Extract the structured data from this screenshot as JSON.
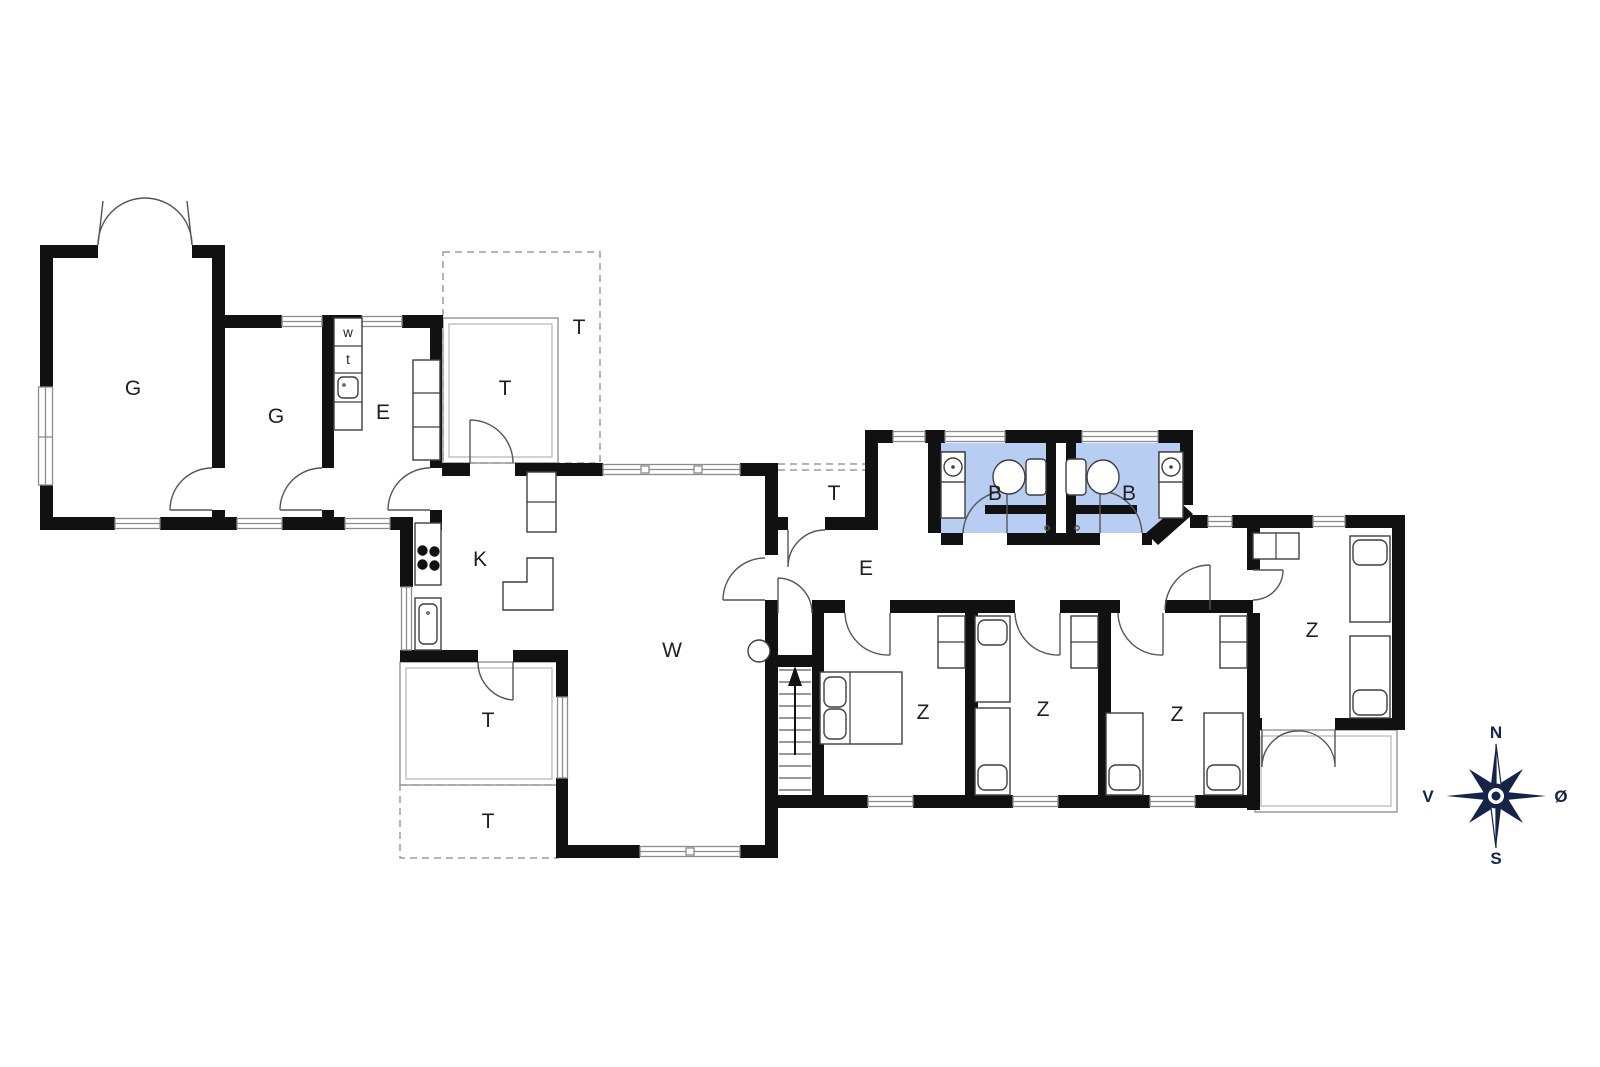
{
  "plan": {
    "type": "floorplan",
    "rooms": [
      {
        "id": "g-large",
        "label": "G"
      },
      {
        "id": "g-small",
        "label": "G"
      },
      {
        "id": "e-utility",
        "label": "E"
      },
      {
        "id": "t-porch",
        "label": "T"
      },
      {
        "id": "t-open",
        "label": "T"
      },
      {
        "id": "k-kitchen",
        "label": "K"
      },
      {
        "id": "w-living",
        "label": "W"
      },
      {
        "id": "t-small",
        "label": "T"
      },
      {
        "id": "e-hall",
        "label": "E"
      },
      {
        "id": "b-left",
        "label": "B"
      },
      {
        "id": "b-right",
        "label": "B"
      },
      {
        "id": "z-east",
        "label": "Z"
      },
      {
        "id": "z-1",
        "label": "Z"
      },
      {
        "id": "z-2",
        "label": "Z"
      },
      {
        "id": "z-3",
        "label": "Z"
      },
      {
        "id": "t-sw-upper",
        "label": "T"
      },
      {
        "id": "t-sw-lower",
        "label": "T"
      }
    ],
    "fixtures": {
      "washer": "w",
      "dryer": "t"
    },
    "compass": {
      "north": "N",
      "south": "S",
      "west": "V",
      "east": "Ø"
    }
  },
  "colors": {
    "wall": "#111111",
    "bathroom_fill": "#b7cdf1",
    "window_line": "#8c8c8c",
    "terrace_line": "#9b9b9b",
    "door_line": "#555555",
    "furniture_line": "#3f3f3f",
    "compass": "#16244a"
  }
}
